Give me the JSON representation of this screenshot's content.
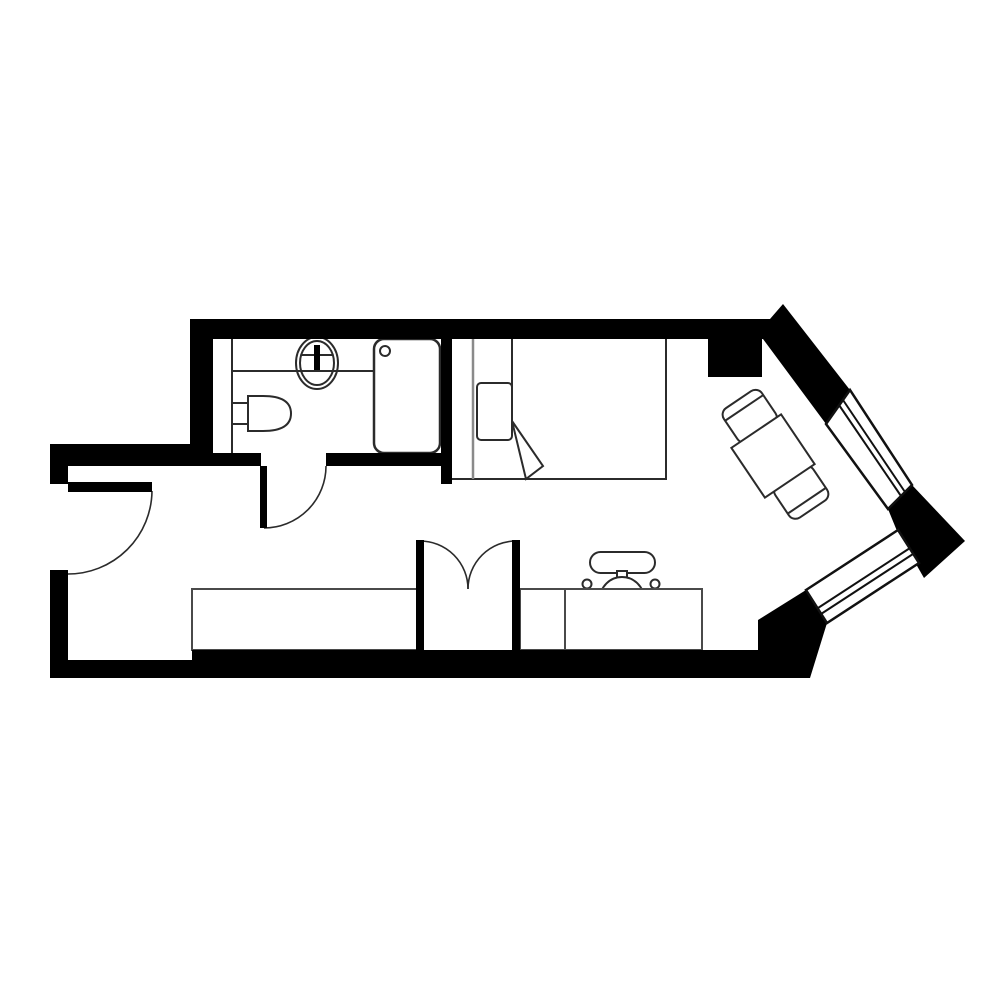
{
  "canvas": {
    "width": 1000,
    "height": 1000,
    "background": "#ffffff",
    "wall_color": "#000000",
    "line_color": "#2b2b2b"
  },
  "plan": {
    "layers": [
      {
        "name": "furniture-layer",
        "shapes": [
          {
            "name": "bed-outline",
            "type": "rect",
            "x": 451,
            "y": 337,
            "w": 215,
            "h": 142,
            "fill": "#ffffff",
            "stroke": "#2b2b2b",
            "sw": 2
          },
          {
            "name": "bed-headboard-line",
            "type": "line",
            "x1": 473,
            "y1": 337,
            "x2": 473,
            "y2": 479,
            "stroke": "#8a8a8a",
            "sw": 2.5
          },
          {
            "name": "bed-pillow",
            "type": "rect",
            "x": 477,
            "y": 383,
            "w": 35,
            "h": 57,
            "rx": 4,
            "fill": "#ffffff",
            "stroke": "#2b2b2b",
            "sw": 2
          },
          {
            "name": "bed-sheet-fold-line",
            "type": "line",
            "x1": 512,
            "y1": 337,
            "x2": 512,
            "y2": 421,
            "stroke": "#2b2b2b",
            "sw": 2
          },
          {
            "name": "bed-sheet-fold-triangle",
            "type": "path",
            "d": "M512,421 L543,466 L526,479 Z",
            "fill": "#ffffff",
            "stroke": "#2b2b2b",
            "sw": 2
          },
          {
            "name": "dining-chair-top",
            "type": "rect",
            "x": -20,
            "y": -66,
            "w": 46,
            "h": 40,
            "rx": 8,
            "fill": "#ffffff",
            "stroke": "#2b2b2b",
            "sw": 2,
            "transform": "translate(773,456) rotate(-34)"
          },
          {
            "name": "dining-chair-top-backrest-line",
            "type": "line",
            "x1": -20,
            "y1": -56,
            "x2": 26,
            "y2": -56,
            "stroke": "#2b2b2b",
            "sw": 2,
            "transform": "translate(773,456) rotate(-34)"
          },
          {
            "name": "dining-chair-bottom",
            "type": "rect",
            "x": -20,
            "y": 26,
            "w": 46,
            "h": 40,
            "rx": 8,
            "fill": "#ffffff",
            "stroke": "#2b2b2b",
            "sw": 2,
            "transform": "translate(773,456) rotate(-34)"
          },
          {
            "name": "dining-chair-bottom-backrest-line",
            "type": "line",
            "x1": -20,
            "y1": 56,
            "x2": 26,
            "y2": 56,
            "stroke": "#2b2b2b",
            "sw": 2,
            "transform": "translate(773,456) rotate(-34)"
          },
          {
            "name": "dining-table",
            "type": "rect",
            "x": -30,
            "y": -30,
            "w": 60,
            "h": 60,
            "fill": "#ffffff",
            "stroke": "#2b2b2b",
            "sw": 2,
            "transform": "translate(773,456) rotate(-34)"
          },
          {
            "name": "office-chair-backrest",
            "type": "rect",
            "x": 590,
            "y": 552,
            "w": 65,
            "h": 21,
            "rx": 10.5,
            "fill": "#ffffff",
            "stroke": "#2b2b2b",
            "sw": 2
          },
          {
            "name": "office-chair-stem",
            "type": "rect",
            "x": 617,
            "y": 571,
            "w": 10,
            "h": 12,
            "fill": "#ffffff",
            "stroke": "#2b2b2b",
            "sw": 2
          },
          {
            "name": "office-chair-seat",
            "type": "circle",
            "cx": 622,
            "cy": 599,
            "r": 22,
            "fill": "#ffffff",
            "stroke": "#2b2b2b",
            "sw": 2
          },
          {
            "name": "office-chair-armrest-left",
            "type": "circle",
            "cx": 587,
            "cy": 584,
            "r": 4.5,
            "fill": "#ffffff",
            "stroke": "#2b2b2b",
            "sw": 2
          },
          {
            "name": "office-chair-armrest-right",
            "type": "circle",
            "cx": 655,
            "cy": 584,
            "r": 4.5,
            "fill": "#ffffff",
            "stroke": "#2b2b2b",
            "sw": 2
          },
          {
            "name": "counter-cabinet",
            "type": "rect",
            "x": 192,
            "y": 589,
            "w": 225,
            "h": 61,
            "fill": "#ffffff",
            "stroke": "#4a4a4a",
            "sw": 2
          },
          {
            "name": "desk",
            "type": "rect",
            "x": 520,
            "y": 589,
            "w": 182,
            "h": 61,
            "fill": "#ffffff",
            "stroke": "#4a4a4a",
            "sw": 2
          },
          {
            "name": "desk-seam-line",
            "type": "line",
            "x1": 565,
            "y1": 589,
            "x2": 565,
            "y2": 650,
            "stroke": "#4a4a4a",
            "sw": 2
          },
          {
            "name": "vanity-divider-line",
            "type": "line",
            "x1": 232,
            "y1": 339,
            "x2": 232,
            "y2": 453,
            "stroke": "#2b2b2b",
            "sw": 2
          },
          {
            "name": "vanity-counter-line",
            "type": "line",
            "x1": 232,
            "y1": 371,
            "x2": 374,
            "y2": 371,
            "stroke": "#2b2b2b",
            "sw": 2
          },
          {
            "name": "sink-basin-outer",
            "type": "ellipse",
            "cx": 317,
            "cy": 363,
            "rx": 21,
            "ry": 26,
            "fill": "none",
            "stroke": "#2b2b2b",
            "sw": 2
          },
          {
            "name": "sink-basin-inner",
            "type": "ellipse",
            "cx": 317,
            "cy": 363,
            "rx": 17,
            "ry": 22,
            "fill": "none",
            "stroke": "#2b2b2b",
            "sw": 2
          },
          {
            "name": "sink-centerline",
            "type": "line",
            "x1": 301,
            "y1": 355,
            "x2": 333,
            "y2": 355,
            "stroke": "#2b2b2b",
            "sw": 2
          },
          {
            "name": "sink-faucet",
            "type": "rect",
            "x": 314,
            "y": 345,
            "w": 6,
            "h": 25,
            "fill": "#000000",
            "stroke": "none",
            "sw": 0
          },
          {
            "name": "toilet-tank",
            "type": "rect",
            "x": 232,
            "y": 403,
            "w": 16,
            "h": 21,
            "fill": "#ffffff",
            "stroke": "#2b2b2b",
            "sw": 2
          },
          {
            "name": "toilet-bowl",
            "type": "path",
            "d": "M248,396 L263,396 Q291,396 291,413.5 Q291,431 263,431 L248,431 Z",
            "fill": "#ffffff",
            "stroke": "#2b2b2b",
            "sw": 2
          },
          {
            "name": "shower-tray",
            "type": "rect",
            "x": 374,
            "y": 339,
            "w": 66,
            "h": 114,
            "rx": 10,
            "fill": "#ffffff",
            "stroke": "#2b2b2b",
            "sw": 2.5
          },
          {
            "name": "shower-drain",
            "type": "circle",
            "cx": 385,
            "cy": 351,
            "r": 5,
            "fill": "none",
            "stroke": "#2b2b2b",
            "sw": 2
          }
        ]
      },
      {
        "name": "door-swing-layer",
        "shapes": [
          {
            "name": "entry-door-swing-arc",
            "type": "path",
            "d": "M152,491 A84,84 0 0 1 68,574",
            "fill": "none",
            "stroke": "#2b2b2b",
            "sw": 1.6
          },
          {
            "name": "bathroom-door-swing-arc",
            "type": "path",
            "d": "M264,528 A62,62 0 0 0 326,466",
            "fill": "none",
            "stroke": "#2b2b2b",
            "sw": 1.6
          },
          {
            "name": "closet-door-swing-arc-left",
            "type": "path",
            "d": "M420,541 A48,48 0 0 1 468,589",
            "fill": "none",
            "stroke": "#2b2b2b",
            "sw": 1.6
          },
          {
            "name": "closet-door-swing-arc-right",
            "type": "path",
            "d": "M516,541 A48,48 0 0 0 468,589",
            "fill": "none",
            "stroke": "#2b2b2b",
            "sw": 1.6
          }
        ]
      },
      {
        "name": "wall-layer",
        "shapes": [
          {
            "name": "top-wall-and-upper-bay-wall",
            "type": "path",
            "d": "M190,319 L770,319 L783,304 L850,390 L826,424 L763,339 L190,339 Z",
            "fill": "#000000",
            "stroke": "none",
            "sw": 0
          },
          {
            "name": "bay-corner-block",
            "type": "path",
            "d": "M888,509 L912,485 L965,541 L924,578 L897,531 Z",
            "fill": "#000000",
            "stroke": "none",
            "sw": 0
          },
          {
            "name": "bathroom-left-wall",
            "type": "rect",
            "x": 190,
            "y": 319,
            "w": 23,
            "h": 136,
            "fill": "#000000",
            "stroke": "none",
            "sw": 0
          },
          {
            "name": "entry-top-wall",
            "type": "path",
            "d": "M50,444 L213,444 L213,466 L68,466 L68,484 L50,484 Z",
            "fill": "#000000",
            "stroke": "none",
            "sw": 0
          },
          {
            "name": "left-wall",
            "type": "rect",
            "x": 50,
            "y": 570,
            "w": 18,
            "h": 108,
            "fill": "#000000",
            "stroke": "none",
            "sw": 0
          },
          {
            "name": "bathroom-bottom-wall-left",
            "type": "rect",
            "x": 213,
            "y": 453,
            "w": 48,
            "h": 13,
            "fill": "#000000",
            "stroke": "none",
            "sw": 0
          },
          {
            "name": "bathroom-bottom-wall-right",
            "type": "rect",
            "x": 326,
            "y": 453,
            "w": 126,
            "h": 13,
            "fill": "#000000",
            "stroke": "none",
            "sw": 0
          },
          {
            "name": "shower-partition-wall",
            "type": "rect",
            "x": 441,
            "y": 335,
            "w": 11,
            "h": 149,
            "fill": "#000000",
            "stroke": "none",
            "sw": 0
          },
          {
            "name": "bathroom-door-leaf",
            "type": "rect",
            "x": 260,
            "y": 466,
            "w": 7,
            "h": 62,
            "fill": "#000000",
            "stroke": "none",
            "sw": 0
          },
          {
            "name": "entry-door-leaf",
            "type": "rect",
            "x": 68,
            "y": 482,
            "w": 84,
            "h": 10,
            "fill": "#000000",
            "stroke": "none",
            "sw": 0
          },
          {
            "name": "structural-column",
            "type": "rect",
            "x": 708,
            "y": 337,
            "w": 54,
            "h": 40,
            "fill": "#000000",
            "stroke": "none",
            "sw": 0
          },
          {
            "name": "closet-post-left",
            "type": "rect",
            "x": 416,
            "y": 540,
            "w": 8,
            "h": 112,
            "fill": "#000000",
            "stroke": "none",
            "sw": 0
          },
          {
            "name": "closet-post-right",
            "type": "rect",
            "x": 512,
            "y": 540,
            "w": 8,
            "h": 112,
            "fill": "#000000",
            "stroke": "none",
            "sw": 0
          },
          {
            "name": "bottom-wall-and-lower-bay-wall",
            "type": "path",
            "d": "M50,660 L192,660 L192,650 L758,650 L758,620 L806,590 L827,623 L810,678 L50,678 Z",
            "fill": "#000000",
            "stroke": "none",
            "sw": 0
          }
        ]
      },
      {
        "name": "window-layer",
        "shapes": [
          {
            "name": "bay-window-upper",
            "type": "polygon",
            "points": "826,424 850,390 912,485 888,509",
            "fill": "#ffffff",
            "stroke": "#111111",
            "sw": 2.5
          },
          {
            "name": "bay-window-upper-glazing-1",
            "type": "line",
            "x1": 839,
            "y1": 405,
            "x2": 901,
            "y2": 496,
            "stroke": "#111111",
            "sw": 2
          },
          {
            "name": "bay-window-upper-glazing-2",
            "type": "line",
            "x1": 843,
            "y1": 400,
            "x2": 905,
            "y2": 492,
            "stroke": "#111111",
            "sw": 2
          },
          {
            "name": "bay-window-lower",
            "type": "polygon",
            "points": "806,590 898,530 919,563 827,623",
            "fill": "#ffffff",
            "stroke": "#111111",
            "sw": 2.5
          },
          {
            "name": "bay-window-lower-glazing-1",
            "type": "line",
            "x1": 818,
            "y1": 608,
            "x2": 910,
            "y2": 548,
            "stroke": "#111111",
            "sw": 2
          },
          {
            "name": "bay-window-lower-glazing-2",
            "type": "line",
            "x1": 821,
            "y1": 614,
            "x2": 913,
            "y2": 554,
            "stroke": "#111111",
            "sw": 2
          }
        ]
      }
    ]
  }
}
